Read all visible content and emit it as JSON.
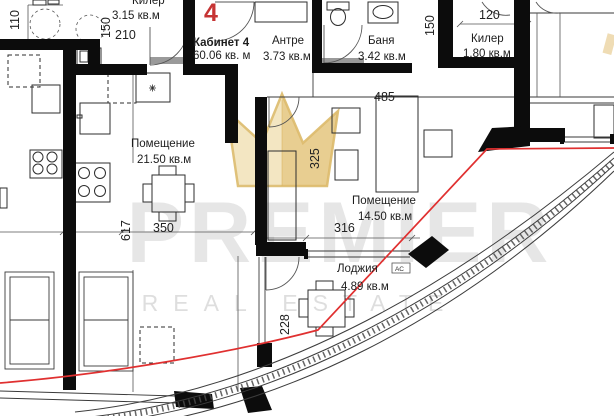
{
  "watermark": {
    "brand": "PREMIER",
    "tagline": "REAL ESTATE"
  },
  "apartment": {
    "number": "4",
    "name": "Кабинет 4",
    "total_area": "60.06 кв. м"
  },
  "rooms": {
    "antre": {
      "name": "Антре",
      "area": "3.73 кв.м"
    },
    "banya": {
      "name": "Баня",
      "area": "3.42 кв.м"
    },
    "kiler_top": {
      "name": "Килер",
      "area": "3.15 кв.м"
    },
    "kiler_right": {
      "name": "Килер",
      "area": "1.80 кв.м"
    },
    "room_kitchen": {
      "name": "Помещение",
      "area": "21.50 кв.м"
    },
    "room_living": {
      "name": "Помещение",
      "area": "14.50 кв.м"
    },
    "loggia": {
      "name": "Лоджия",
      "area": "4.89 кв.м",
      "ac_label": "АС"
    }
  },
  "dims": {
    "d110": "110",
    "d150_left": "150",
    "d210": "210",
    "d120": "120",
    "d150_right": "150",
    "d485": "485",
    "d325": "325",
    "d617": "617",
    "d350": "350",
    "d316": "316",
    "d228": "228"
  },
  "colors": {
    "boundary_red": "#e03030",
    "apartment_number_red": "#c63434",
    "wall_black": "#0c0c0c",
    "watermark_gold": "#dfb96a",
    "watermark_gray": "#c7c7c7"
  }
}
